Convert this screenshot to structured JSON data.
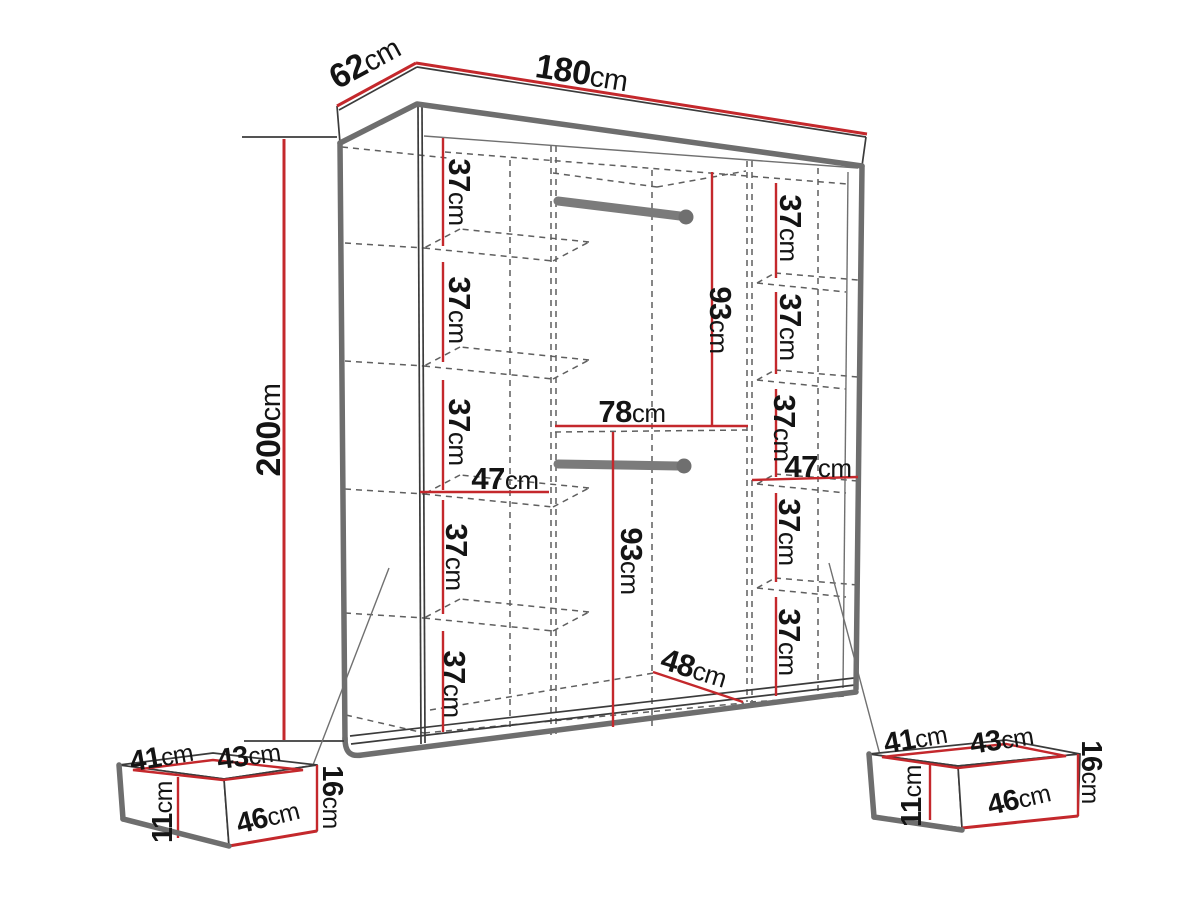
{
  "page": {
    "title": "Wardrobe dimension diagram"
  },
  "dims": {
    "d62": {
      "n": "62",
      "u": "cm"
    },
    "d180": {
      "n": "180",
      "u": "cm"
    },
    "d200": {
      "n": "200",
      "u": "cm"
    },
    "d37": {
      "n": "37",
      "u": "cm"
    },
    "d47": {
      "n": "47",
      "u": "cm"
    },
    "d78": {
      "n": "78",
      "u": "cm"
    },
    "d93": {
      "n": "93",
      "u": "cm"
    },
    "d48": {
      "n": "48",
      "u": "cm"
    },
    "d41": {
      "n": "41",
      "u": "cm"
    },
    "d43": {
      "n": "43",
      "u": "cm"
    },
    "d16": {
      "n": "16",
      "u": "cm"
    },
    "d46": {
      "n": "46",
      "u": "cm"
    },
    "d11": {
      "n": "11",
      "u": "cm"
    }
  },
  "wardrobe": {
    "exterior": {
      "width": "180cm",
      "depth": "62cm",
      "height": "200cm"
    },
    "left_column": {
      "clear_width": "47cm",
      "shelf_gaps": [
        "37cm",
        "37cm",
        "37cm",
        "37cm",
        "37cm"
      ]
    },
    "right_column": {
      "clear_width": "47cm",
      "shelf_gaps": [
        "37cm",
        "37cm",
        "37cm",
        "37cm",
        "37cm"
      ]
    },
    "center_section": {
      "clear_width": "78cm",
      "upper_hanging_height": "93cm",
      "lower_hanging_height": "93cm",
      "floor_depth": "48cm"
    },
    "hanging_rods": 2
  },
  "drawers": {
    "count": 2,
    "each": {
      "top_left_edge": "41cm",
      "top_right_edge": "43cm",
      "front_width": "46cm",
      "height": "16cm",
      "inner_height": "11cm"
    }
  },
  "colors": {
    "dimension_red": "#c4282c",
    "outline_gray": "#6e6e6e",
    "line_dark": "#3b3b3b",
    "text": "#141414",
    "rod_gray": "#7b7b7b",
    "background": "#ffffff"
  }
}
